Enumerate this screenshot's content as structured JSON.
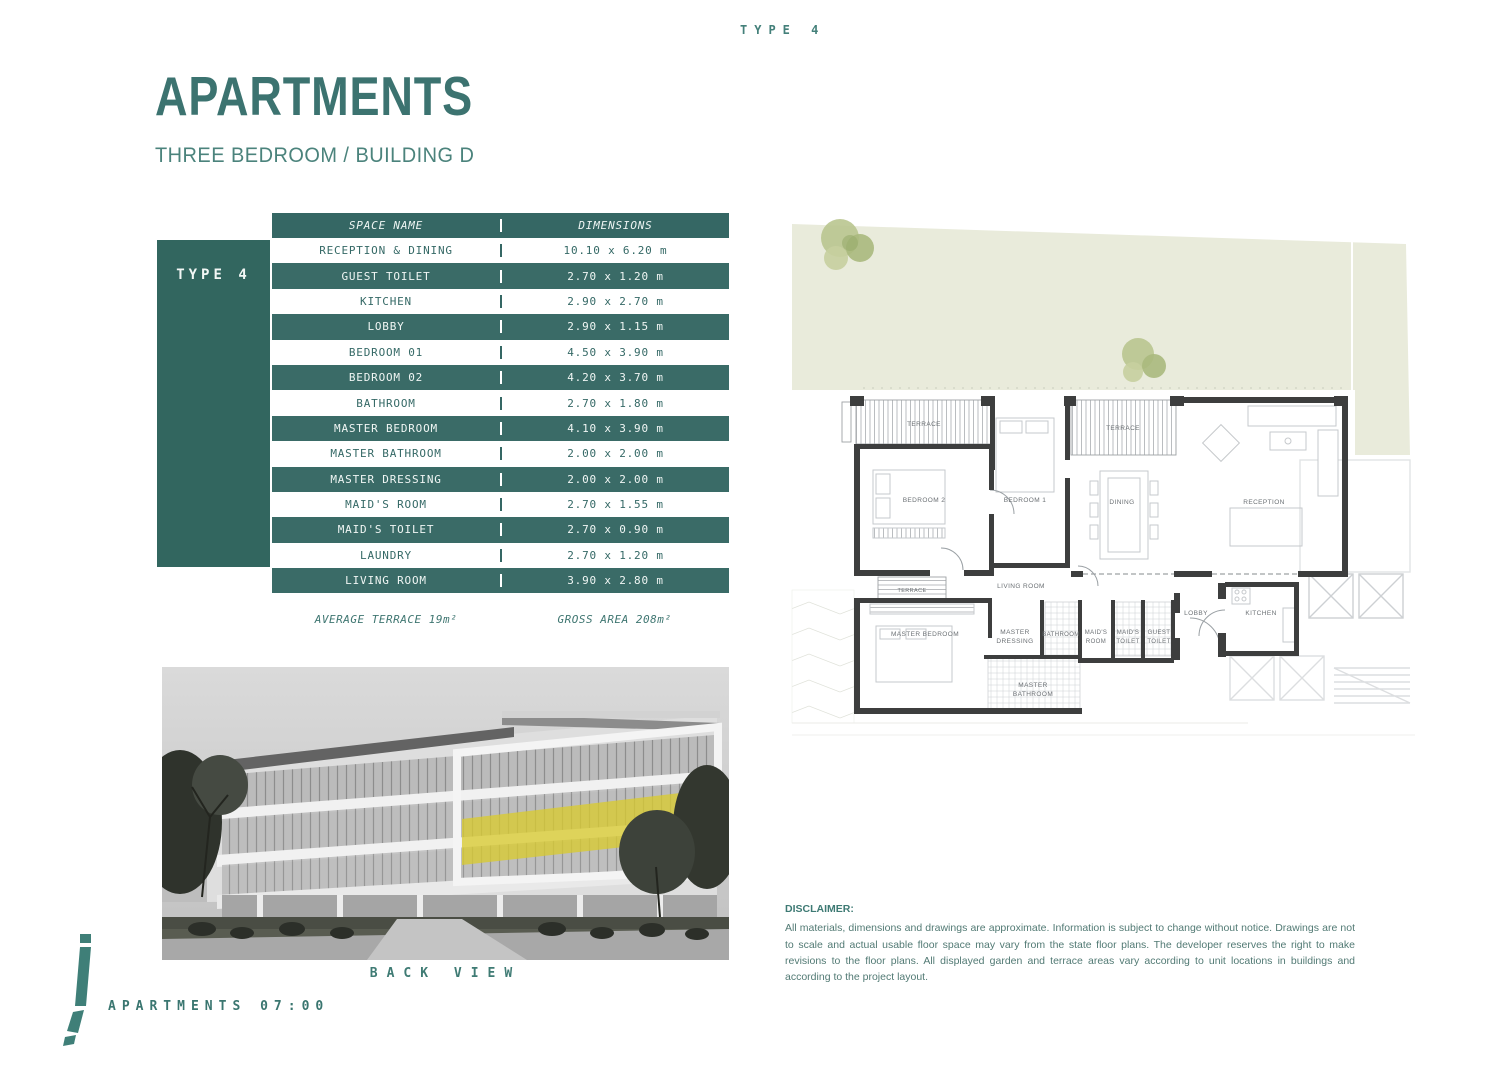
{
  "header": {
    "type_tag": "TYPE 4",
    "title": "APARTMENTS",
    "subtitle": "THREE  BEDROOM / BUILDING D"
  },
  "sidebar": {
    "type_label": "TYPE 4"
  },
  "table": {
    "columns": {
      "name": "SPACE NAME",
      "dim": "DIMENSIONS"
    },
    "rows": [
      {
        "name": "RECEPTION & DINING",
        "dim": "10.10 x 6.20 m"
      },
      {
        "name": "GUEST TOILET",
        "dim": "2.70 x 1.20 m"
      },
      {
        "name": "KITCHEN",
        "dim": "2.90 x 2.70 m"
      },
      {
        "name": "LOBBY",
        "dim": "2.90 x 1.15 m"
      },
      {
        "name": "BEDROOM 01",
        "dim": "4.50 x 3.90 m"
      },
      {
        "name": "BEDROOM 02",
        "dim": "4.20 x 3.70 m"
      },
      {
        "name": "BATHROOM",
        "dim": "2.70 x 1.80 m"
      },
      {
        "name": "MASTER BEDROOM",
        "dim": "4.10 x 3.90 m"
      },
      {
        "name": "MASTER BATHROOM",
        "dim": "2.00 x 2.00 m"
      },
      {
        "name": "MASTER DRESSING",
        "dim": "2.00 x 2.00 m"
      },
      {
        "name": "MAID'S ROOM",
        "dim": "2.70 x 1.55 m"
      },
      {
        "name": "MAID'S TOILET",
        "dim": "2.70 x 0.90 m"
      },
      {
        "name": "LAUNDRY",
        "dim": "2.70 x 1.20 m"
      },
      {
        "name": "LIVING ROOM",
        "dim": "3.90 x 2.80 m"
      }
    ],
    "notes": {
      "terrace": "AVERAGE TERRACE 19m²",
      "gross": "GROSS AREA 208m²"
    }
  },
  "floorplan": {
    "rooms": [
      {
        "l1": "TERRACE"
      },
      {
        "l1": "BEDROOM 2"
      },
      {
        "l1": "BEDROOM 1"
      },
      {
        "l1": "TERRACE"
      },
      {
        "l1": "DINING"
      },
      {
        "l1": "RECEPTION"
      },
      {
        "l1": "LIVING ROOM"
      },
      {
        "l1": "TERRACE"
      },
      {
        "l1": "MASTER BEDROOM"
      },
      {
        "l1": "MASTER",
        "l2": "DRESSING"
      },
      {
        "l1": "BATHROOM"
      },
      {
        "l1": "MAID'S",
        "l2": "ROOM"
      },
      {
        "l1": "MAID'S",
        "l2": "TOILET"
      },
      {
        "l1": "GUEST",
        "l2": "TOILET"
      },
      {
        "l1": "LOBBY"
      },
      {
        "l1": "KITCHEN"
      },
      {
        "l1": "MASTER",
        "l2": "BATHROOM"
      }
    ]
  },
  "photo": {
    "caption": "BACK VIEW"
  },
  "footer": {
    "brand": "APARTMENTS 07:00"
  },
  "disclaimer": {
    "heading": "DISCLAIMER:",
    "body": "All materials, dimensions and drawings are approximate. Information is subject to change without notice. Drawings are not to scale and actual usable floor space may vary from the state floor plans. The developer reserves the right to make revisions to the floor plans. All displayed garden and terrace areas vary according to unit locations in buildings and according to the project layout."
  },
  "colors": {
    "accent_teal": "#356764",
    "row_teal": "#3a6b67",
    "garden_green": "#e9ebdb",
    "highlight_yellow": "#d8ca2f"
  }
}
